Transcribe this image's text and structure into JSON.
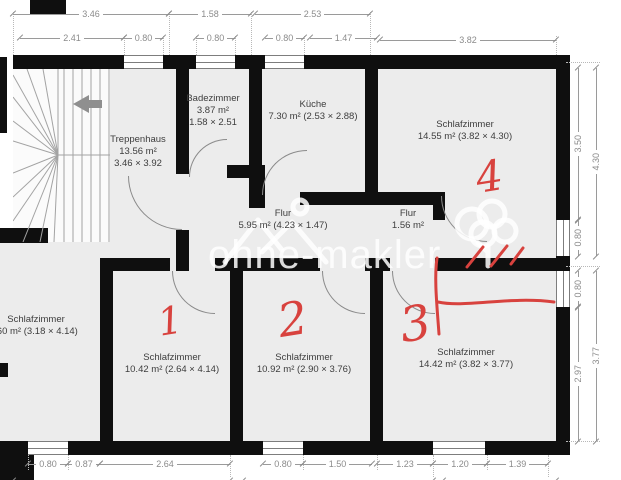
{
  "plan": {
    "watermark": "ohne-makler",
    "rooms": {
      "treppenhaus": {
        "name": "Treppenhaus",
        "area": "13.56 m²",
        "size": "3.46 × 3.92"
      },
      "badezimmer": {
        "name": "Badezimmer",
        "area": "3.87 m²",
        "size": "1.58 × 2.51"
      },
      "kueche": {
        "name": "Küche",
        "detail": "7.30 m² (2.53 × 2.88)"
      },
      "schlafzimmer4": {
        "name": "Schlafzimmer",
        "detail": "14.55 m² (3.82 × 4.30)"
      },
      "flur": {
        "name": "Flur",
        "detail": "5.95 m² (4.23 × 1.47)"
      },
      "flur2": {
        "name": "Flur",
        "detail": "1.56 m²"
      },
      "schlafzimmer_left": {
        "name": "Schlafzimmer",
        "detail": ".60 m² (3.18 × 4.14)"
      },
      "schlafzimmer1": {
        "name": "Schlafzimmer",
        "detail": "10.42 m² (2.64 × 4.14)"
      },
      "schlafzimmer2": {
        "name": "Schlafzimmer",
        "detail": "10.92 m² (2.90 × 3.76)"
      },
      "schlafzimmer3": {
        "name": "Schlafzimmer",
        "detail": "14.42 m² (3.82 × 3.77)"
      }
    },
    "annotations": {
      "num1": "1",
      "num2": "2",
      "num3": "3",
      "num4": "4"
    },
    "dims": {
      "top1": [
        "3.46",
        "1.58",
        "2.53"
      ],
      "top2": [
        "2.41",
        "0.80",
        "0.80",
        "0.80",
        "1.47",
        "3.82"
      ],
      "right": [
        "3.50",
        "4.30",
        "0.80",
        "0.80",
        "2.97",
        "3.77"
      ],
      "bottom": [
        "0.80",
        "0.87",
        "2.64",
        "0.80",
        "1.50",
        "1.23",
        "1.20",
        "1.39"
      ]
    },
    "colors": {
      "annotation_red": "#d8423e",
      "wall": "#0f0f0f",
      "floor": "#ececec"
    }
  }
}
